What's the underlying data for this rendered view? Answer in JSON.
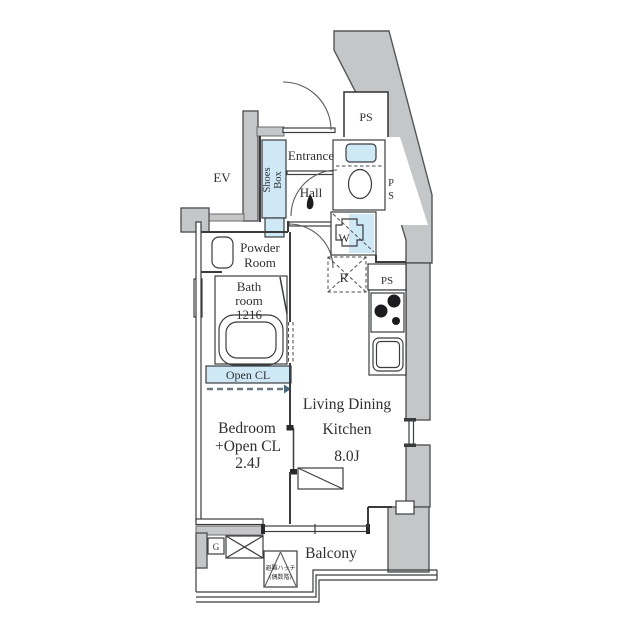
{
  "plan": {
    "labels": {
      "ev": "EV",
      "ps_top": "PS",
      "ps_side_p": "P",
      "ps_side_s": "S",
      "ps_kitchen": "PS",
      "shoes_line1": "Shoes",
      "shoes_line2": "Box",
      "entrance": "Entrance",
      "hall": "Hall",
      "powder_line1": "Powder",
      "powder_line2": "Room",
      "bath_line1": "Bath",
      "bath_line2": "room",
      "bath_line3": "1216",
      "open_cl": "Open CL",
      "washer": "W",
      "fridge": "R",
      "gas_meter": "G",
      "bedroom_line1": "Bedroom",
      "bedroom_line2": "+Open CL",
      "bedroom_size": "2.4J",
      "ldk_line1": "Living Dining",
      "ldk_line2": "Kitchen",
      "ldk_size": "8.0J",
      "balcony": "Balcony",
      "hatch_line1": "避難ハッチ",
      "hatch_line2": "(偶数階)"
    },
    "colors": {
      "structural_wall": "#c5c6c8",
      "wall_outline": "#55565a",
      "interior_line": "#3b3c3e",
      "fixture_blue": "#cfe8f6",
      "text": "#2f3033",
      "background": "#ffffff"
    }
  }
}
